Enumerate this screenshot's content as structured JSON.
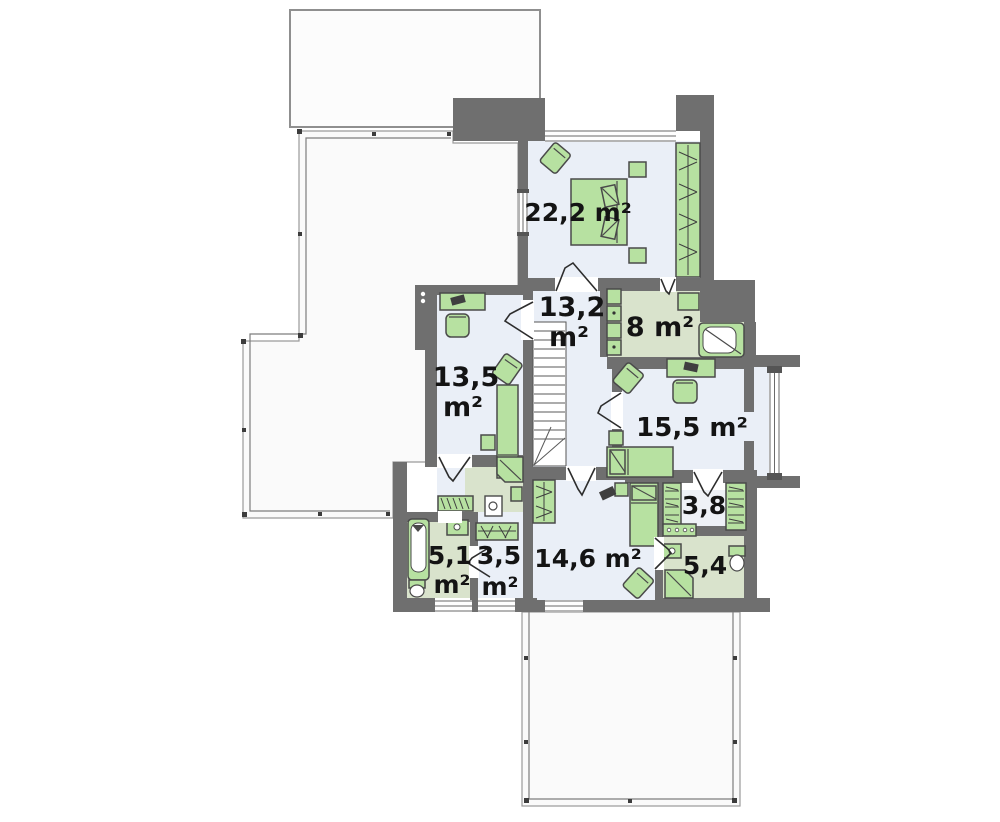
{
  "plan": {
    "type": "floor-plan",
    "floor": "upper-floor",
    "rooms": [
      {
        "id": "bedroom-22",
        "kind": "bedroom",
        "label": "22,2 m²"
      },
      {
        "id": "hall-stairs",
        "kind": "hall",
        "label": "13,2",
        "label2": "m²"
      },
      {
        "id": "bathroom-8",
        "kind": "bathroom",
        "label": "8 m²"
      },
      {
        "id": "bedroom-13",
        "kind": "bedroom",
        "label": "13,5",
        "label2": "m²"
      },
      {
        "id": "bedroom-15",
        "kind": "bedroom",
        "label": "15,5 m²"
      },
      {
        "id": "wardrobe-38",
        "kind": "wardrobe",
        "label": "3,8"
      },
      {
        "id": "bedroom-14",
        "kind": "bedroom",
        "label": "14,6 m²"
      },
      {
        "id": "bathroom-51",
        "kind": "bathroom",
        "label": "5,1",
        "label2": "m²"
      },
      {
        "id": "utility-35",
        "kind": "utility",
        "label": "3,5",
        "label2": "m²"
      },
      {
        "id": "bathroom-54",
        "kind": "bathroom",
        "label": "5,4"
      }
    ],
    "colors": {
      "wall": "#6f6f6f",
      "floor": "#eaeff7",
      "floor_bath": "#d9e3cc",
      "furniture": "#b7e1a1",
      "terrace": "#fafafa",
      "text": "#141414"
    }
  }
}
